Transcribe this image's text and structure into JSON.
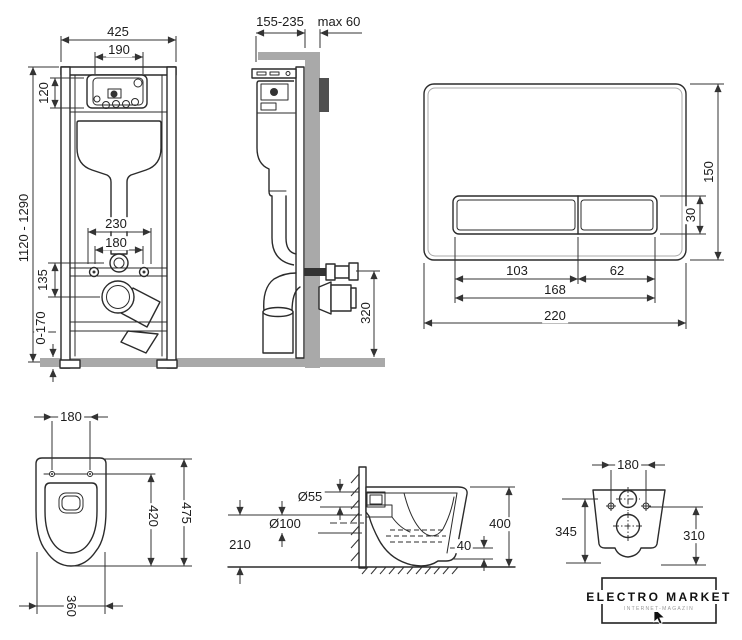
{
  "colors": {
    "line": "#2b2b2b",
    "gray_fill": "#a9a9a9",
    "dark_fill": "#4f4f4f",
    "background": "#ffffff"
  },
  "installation_front": {
    "width": "425",
    "opening_width": "190",
    "opening_height": "120",
    "height_range": "1120 - 1290",
    "anchor_spacing_outer": "230",
    "anchor_spacing_inner": "180",
    "drain_offset": "135",
    "foot_adjustment": "0-170"
  },
  "installation_side": {
    "depth_range": "155-235",
    "wall_allowance": "max 60",
    "outlet_height": "320"
  },
  "flush_plate": {
    "panel_height": "150",
    "button_height": "30",
    "large_button_width": "103",
    "small_button_width": "62",
    "buttons_width": "168",
    "panel_width": "220"
  },
  "bowl_top_view": {
    "hole_spacing": "180",
    "total_depth": "475",
    "inner_depth": "420",
    "width": "360"
  },
  "bowl_side_view": {
    "inlet_diameter": "Ø55",
    "outlet_diameter": "Ø100",
    "outlet_height": "210",
    "bowl_height": "400",
    "bottom_clearance": "40"
  },
  "bowl_back_view": {
    "hole_spacing": "180",
    "left_height": "345",
    "right_height": "310"
  },
  "logo": {
    "title": "ELECTRO MARKET",
    "subtitle": "INTERNET-MAGAZIN"
  }
}
